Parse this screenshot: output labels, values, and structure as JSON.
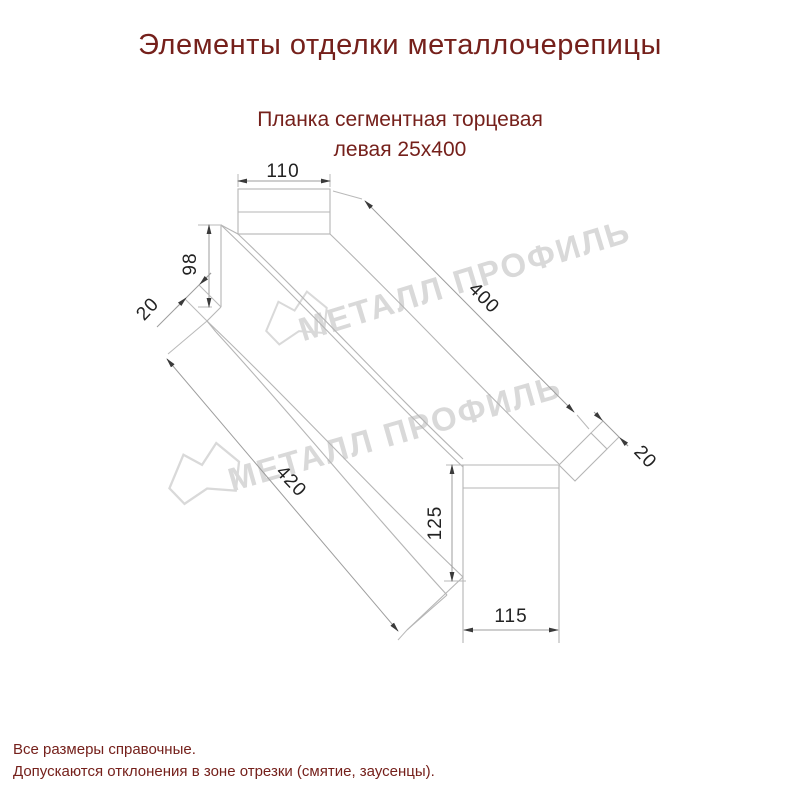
{
  "title": "Элементы отделки металлочерепицы",
  "subtitle": {
    "line1": "Планка сегментная торцевая",
    "line2": "левая 25х400"
  },
  "drawing": {
    "dimensions": {
      "top_width": "110",
      "left_height": "98",
      "left_fold": "20",
      "length": "400",
      "right_fold": "20",
      "bottom_length": "420",
      "end_height": "125",
      "end_width": "115"
    },
    "watermark_text": "МЕТАЛЛ ПРОФИЛЬ"
  },
  "footer": {
    "line1": "Все размеры справочные.",
    "line2": "Допускаются отклонения в зоне отрезки (смятие, заусенцы)."
  },
  "colors": {
    "heading_text": "#75201b",
    "dimension_text": "#222222",
    "drawing_line": "#b5b5b5",
    "watermark": "#d9d9d9",
    "background": "#ffffff"
  }
}
